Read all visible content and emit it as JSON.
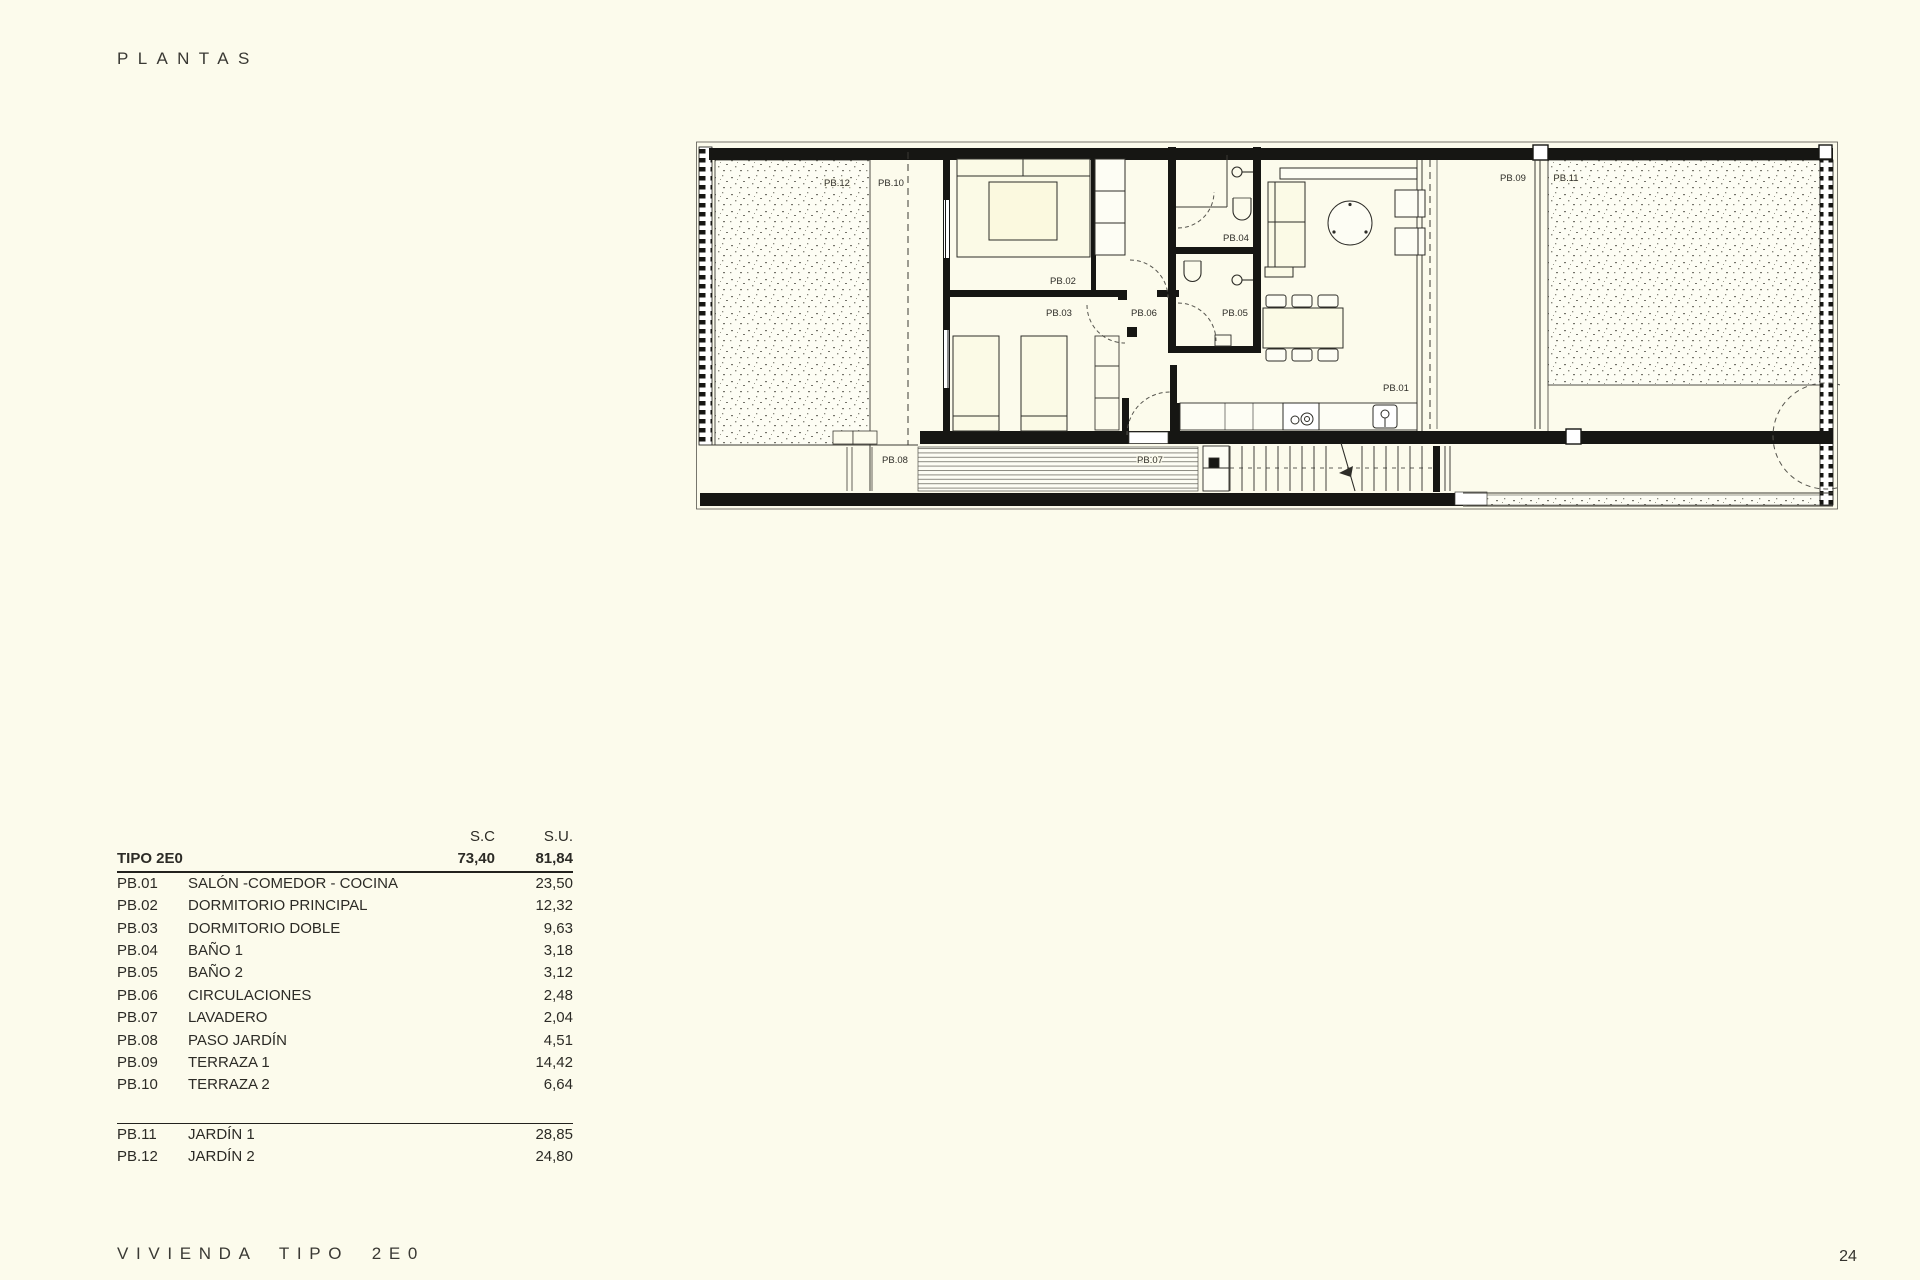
{
  "header": {
    "title": "PLANTAS"
  },
  "footer": {
    "title": "VIVIENDA TIPO 2E0",
    "page_number": "24"
  },
  "area_table": {
    "columns": {
      "sc": "S.C",
      "su": "S.U."
    },
    "total_row": {
      "label": "TIPO 2E0",
      "sc": "73,40",
      "su": "81,84"
    },
    "rows": [
      {
        "code": "PB.01",
        "name": "SALÓN -COMEDOR - COCINA",
        "su": "23,50"
      },
      {
        "code": "PB.02",
        "name": "DORMITORIO PRINCIPAL",
        "su": "12,32"
      },
      {
        "code": "PB.03",
        "name": "DORMITORIO DOBLE",
        "su": "9,63"
      },
      {
        "code": "PB.04",
        "name": "BAÑO 1",
        "su": "3,18"
      },
      {
        "code": "PB.05",
        "name": "BAÑO 2",
        "su": "3,12"
      },
      {
        "code": "PB.06",
        "name": "CIRCULACIONES",
        "su": "2,48"
      },
      {
        "code": "PB.07",
        "name": "LAVADERO",
        "su": "2,04"
      },
      {
        "code": "PB.08",
        "name": "PASO JARDÍN",
        "su": "4,51"
      },
      {
        "code": "PB.09",
        "name": "TERRAZA 1",
        "su": "14,42"
      },
      {
        "code": "PB.10",
        "name": "TERRAZA 2",
        "su": "6,64"
      }
    ],
    "outdoor_rows": [
      {
        "code": "PB.11",
        "name": "JARDÍN 1",
        "su": "28,85"
      },
      {
        "code": "PB.12",
        "name": "JARDÍN 2",
        "su": "24,80"
      }
    ]
  },
  "plan": {
    "labels": [
      {
        "id": "PB.12",
        "x": 142,
        "y": 46
      },
      {
        "id": "PB.10",
        "x": 196,
        "y": 46
      },
      {
        "id": "PB.02",
        "x": 368,
        "y": 144
      },
      {
        "id": "PB.03",
        "x": 364,
        "y": 176
      },
      {
        "id": "PB.06",
        "x": 449,
        "y": 176
      },
      {
        "id": "PB.04",
        "x": 541,
        "y": 101
      },
      {
        "id": "PB.05",
        "x": 540,
        "y": 176
      },
      {
        "id": "PB.01",
        "x": 701,
        "y": 251
      },
      {
        "id": "PB.09",
        "x": 818,
        "y": 41
      },
      {
        "id": "PB.11",
        "x": 871,
        "y": 41
      },
      {
        "id": "PB.08",
        "x": 200,
        "y": 323
      },
      {
        "id": "PB.07",
        "x": 455,
        "y": 323
      }
    ],
    "colors": {
      "wall": "#161613",
      "thin_line": "#3c3b35",
      "paper": "#fcfbec"
    }
  }
}
